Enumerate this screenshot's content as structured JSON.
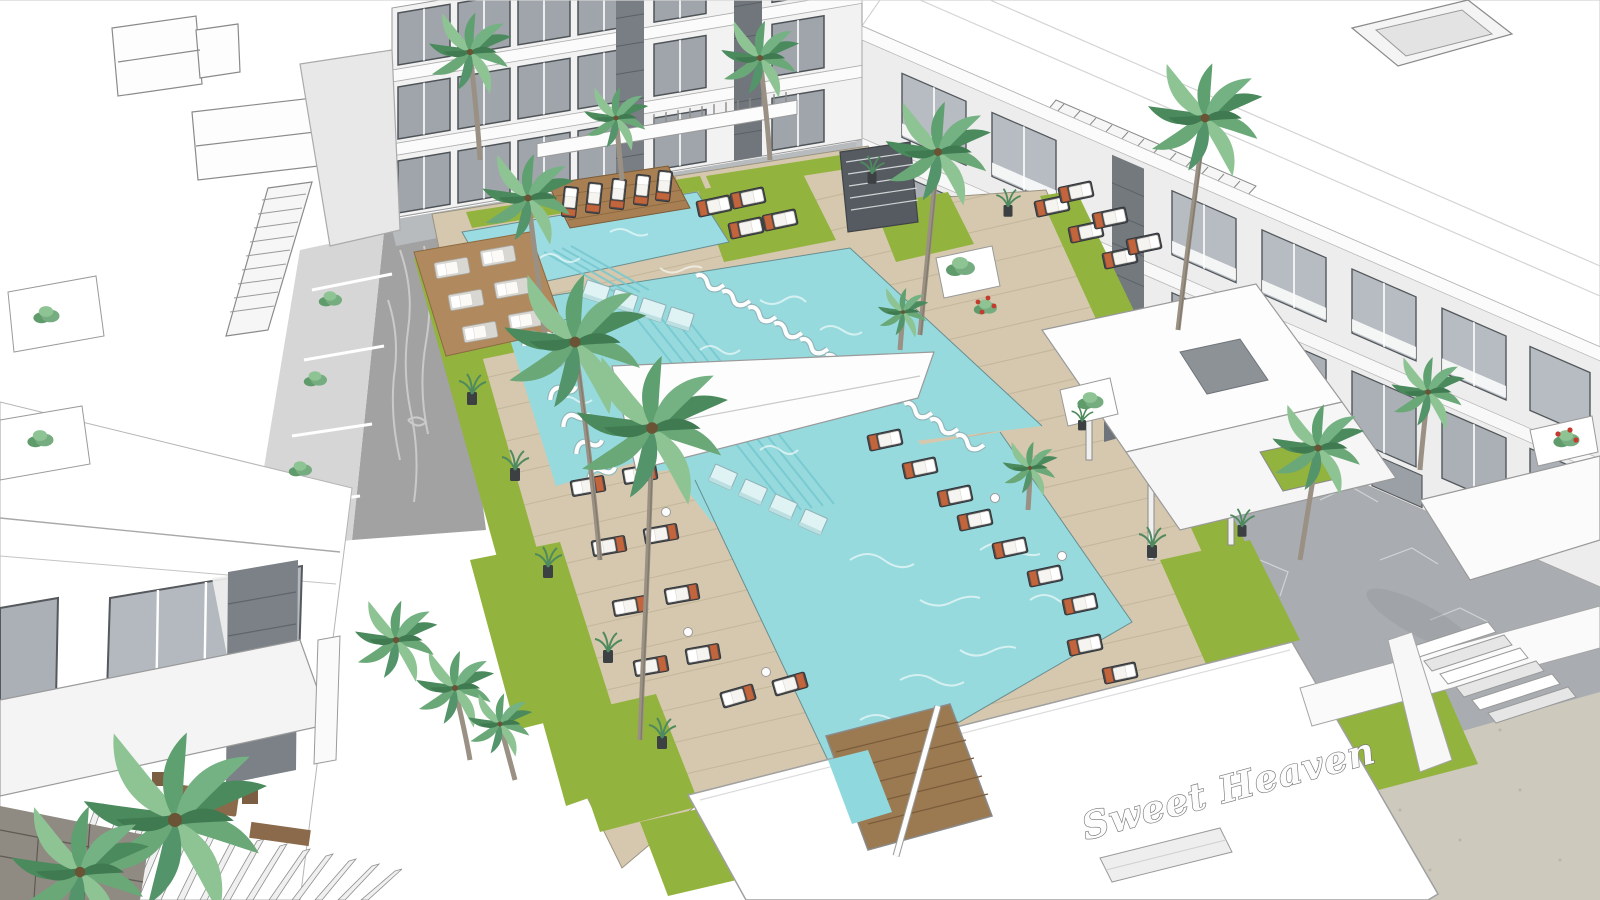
{
  "sign": {
    "text": "Sweet Heaven"
  },
  "scene": {
    "description": "Aerial 3D architectural rendering of a resort apartment complex courtyard with swimming pools",
    "style": "SketchUp-like white architectural render",
    "objects": [
      "three-story apartment building (rear)",
      "three-story apartment building (right)",
      "foreground building with glass doors and pergola (bottom-left)",
      "upper rectangular pool with timber island",
      "main cross-shaped pool with in-pool loungers",
      "timber pool deck",
      "grass borders",
      "stone walkways",
      "sun loungers with white cushions and terracotta towels",
      "palm trees",
      "planters and shrubs",
      "pool-bar canopy with Sweet Heaven signage",
      "entrance pergolas",
      "stairs (bottom-right)"
    ],
    "colors": {
      "pool_water": "#96dade",
      "pool_water_light": "#b7e8ea",
      "deck_wood": "#d5c8ae",
      "deck_lines": "#bdb091",
      "grass": "#93b33f",
      "pavement": "#a9adb1",
      "road": "#a2a2a2",
      "building_white": "#ffffff",
      "building_shadow": "#ececec",
      "glass": "#aab0b5",
      "window_frame": "#4e5357",
      "stone_cladding": "#74797e",
      "lounger_base": "#464a4e",
      "cushion": "#f6f4f0",
      "towel_accent": "#c2653d",
      "island_wood": "#a87f52",
      "palm_green": "#6ba878",
      "palm_trunk": "#9a9184",
      "sand_ground": "#cdc9bd",
      "flower_red": "#c23b2e"
    }
  }
}
